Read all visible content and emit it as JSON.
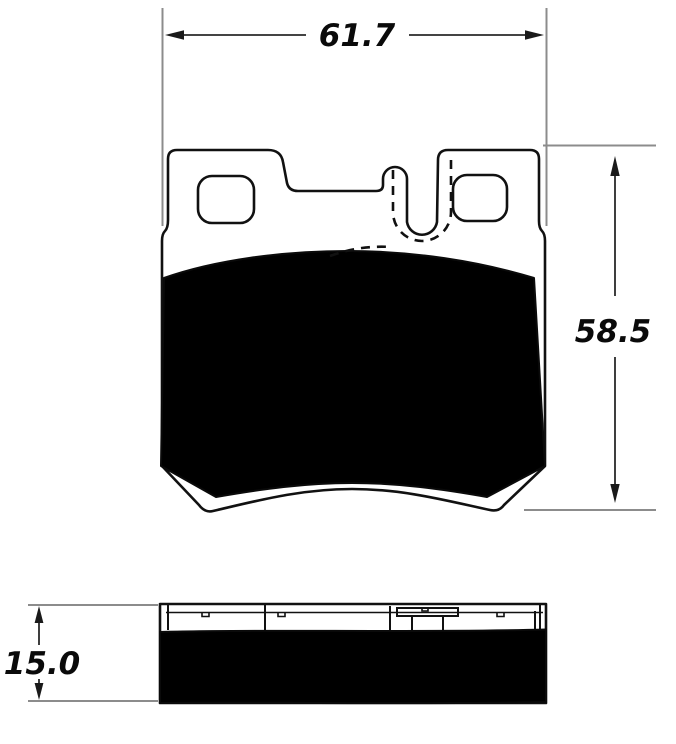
{
  "drawing": {
    "dimensions": {
      "width": {
        "value": "61.7",
        "applies_to": "front-view-width"
      },
      "height": {
        "value": "58.5",
        "applies_to": "front-view-height"
      },
      "thickness": {
        "value": "15.0",
        "applies_to": "side-view-thickness"
      }
    },
    "colors": {
      "line": "#111111",
      "friction_fill": "#000000",
      "extension_line": "#8c8c8c",
      "background": "#ffffff"
    }
  }
}
